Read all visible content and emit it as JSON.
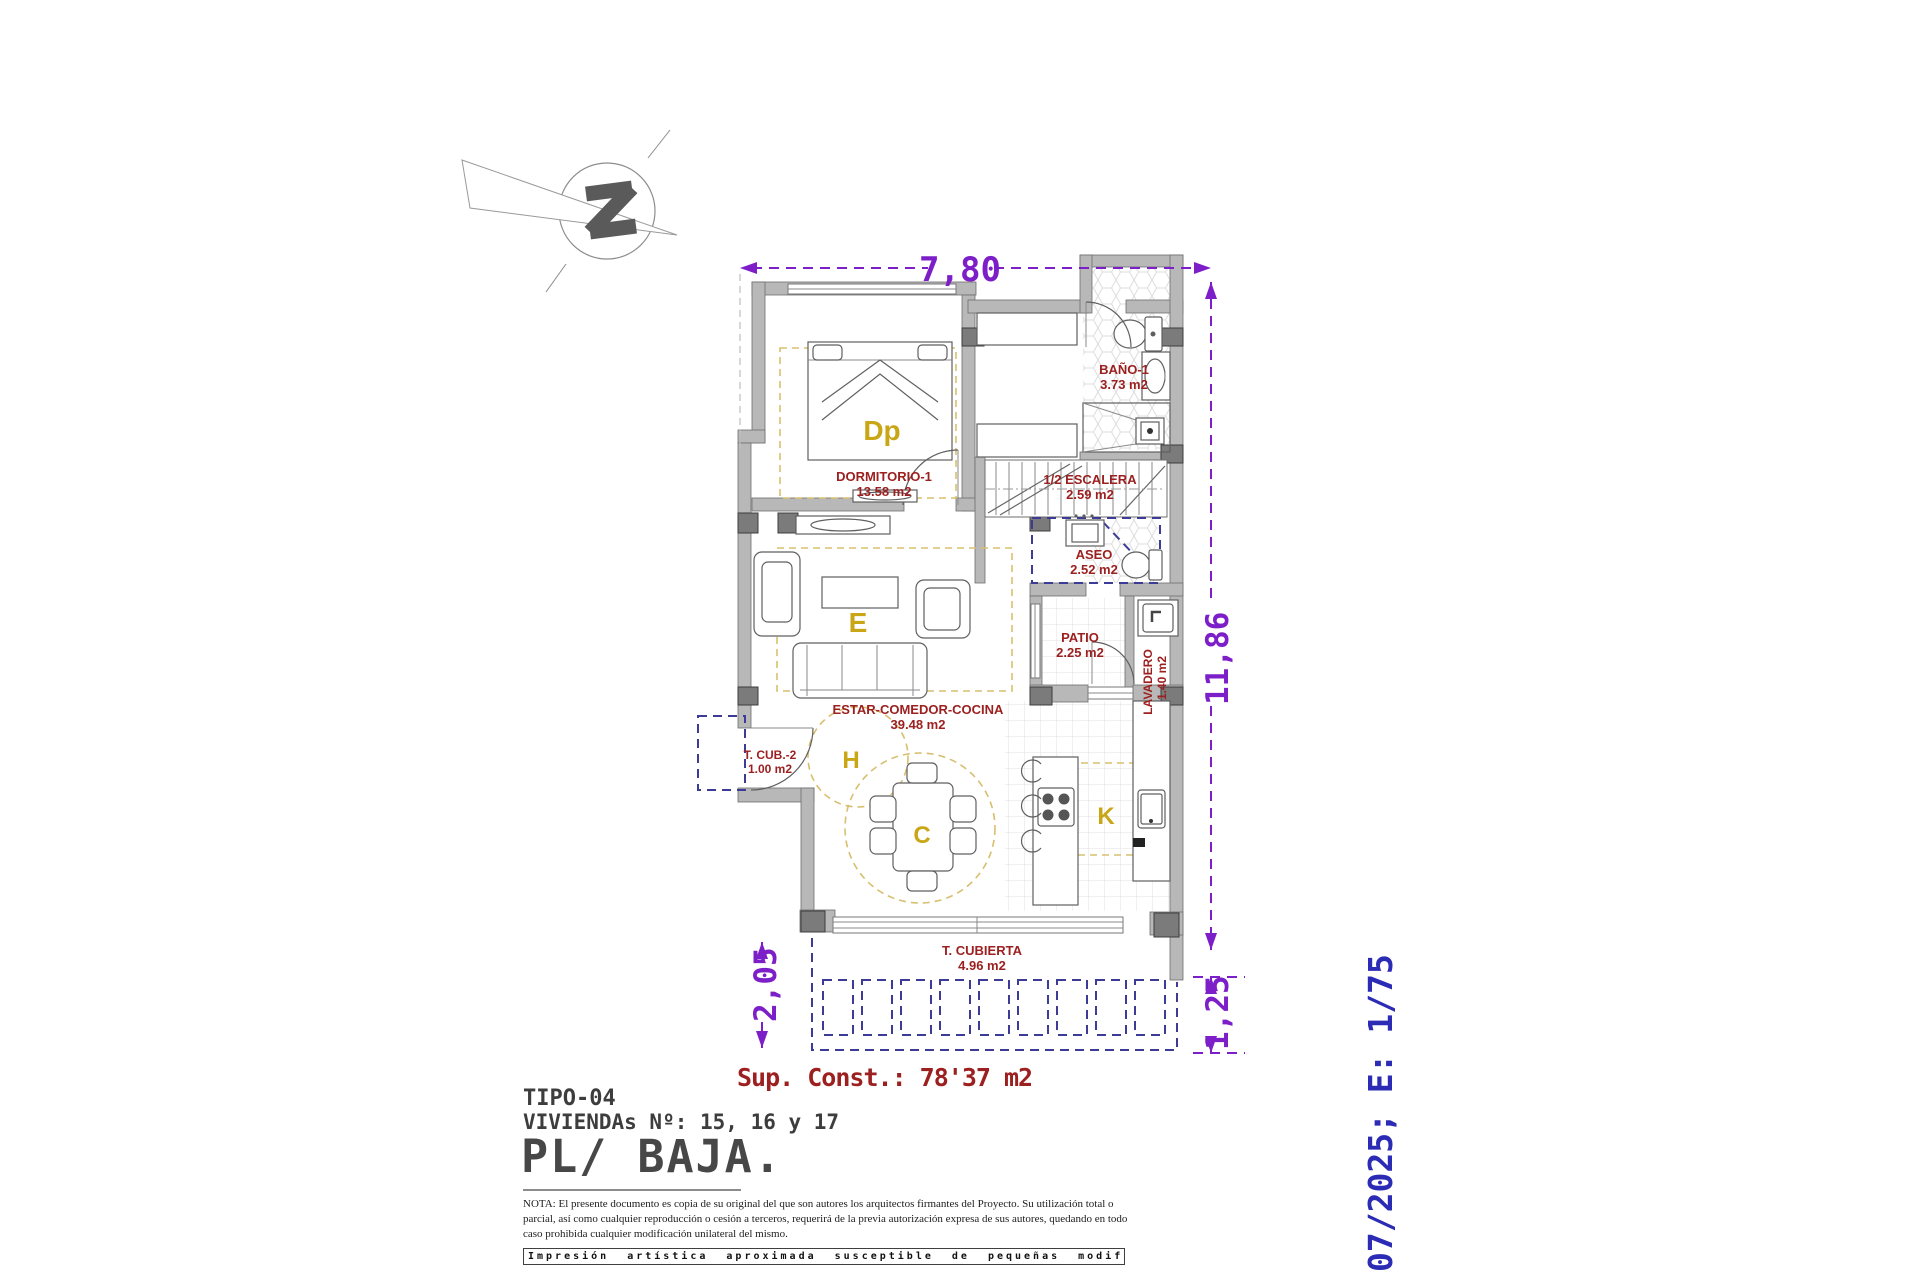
{
  "dims": {
    "top": "7,80",
    "right": "11,86",
    "bottom_left": "2,05",
    "bottom_right": "1,25"
  },
  "rooms": {
    "dormitorio": {
      "name": "DORMITORIO-1",
      "area": "13.58 m2",
      "tag": "Dp"
    },
    "bano": {
      "name": "BAÑO-1",
      "area": "3.73 m2"
    },
    "escalera": {
      "name": "1/2 ESCALERA",
      "area": "2.59 m2"
    },
    "aseo": {
      "name": "ASEO",
      "area": "2.52 m2"
    },
    "patio": {
      "name": "PATIO",
      "area": "2.25 m2"
    },
    "lavadero": {
      "name": "LAVADERO",
      "area": "1.40 m2"
    },
    "estar": {
      "name": "ESTAR-COMEDOR-COCINA",
      "area": "39.48 m2"
    },
    "tags": {
      "living": "E",
      "hall": "H",
      "dining": "C",
      "kitchen": "K"
    },
    "tcub2": {
      "name": "T. CUB.-2",
      "area": "1.00 m2"
    },
    "tcubierta": {
      "name": "T. CUBIERTA",
      "area": "4.96 m2"
    }
  },
  "summary": {
    "sup_const": "Sup. Const.: 78'37 m2"
  },
  "title_block": {
    "tipo": "TIPO-04",
    "viviendas": "VIVIENDAs Nº: 15, 16 y 17",
    "planta": "PL/ BAJA.",
    "nota": "NOTA: El presente documento es copia de su original del que son autores los arquitectos firmantes del Proyecto. Su utilización total o parcial, así como cualquier reproducción o cesión a terceros, requerirá de la previa autorización expresa de sus autores, quedando en todo caso prohibida cualquier modificación unilateral del mismo.",
    "impresion": "Impresión artística aproximada susceptible de pequeñas modificaciones.",
    "fecha_escala": "07/2025; E: 1/75"
  },
  "colors": {
    "dimension_purple": "#7d1fc9",
    "room_label_red": "#9c2020",
    "zone_letter_yellow": "#c9a616",
    "date_blue": "#2b2bb5",
    "wall_gray": "#b8b8b8",
    "area_dash_tan": "#d8bf6e",
    "outline_dash_navy": "#3c3c96"
  }
}
